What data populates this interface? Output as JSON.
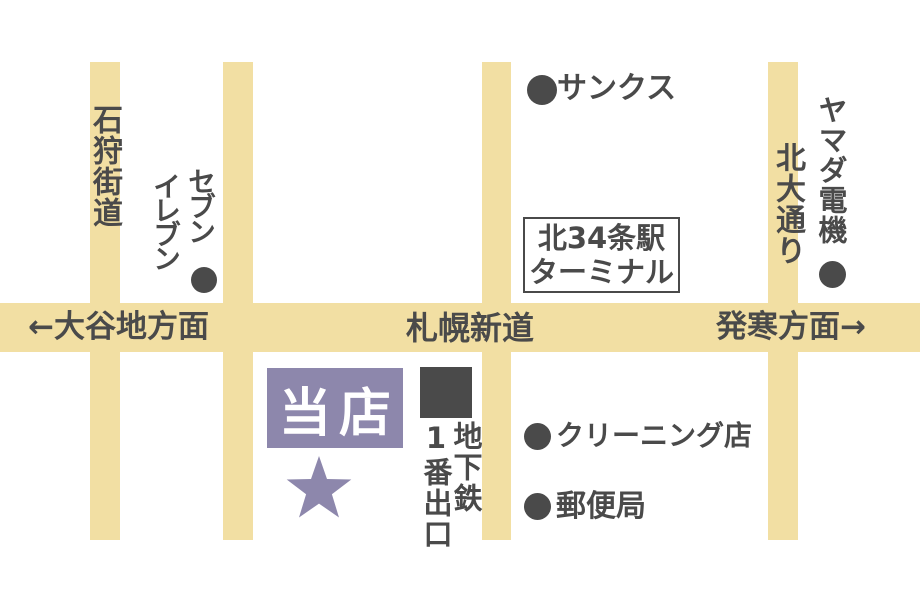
{
  "colors": {
    "background": "#ffffff",
    "road": "#f2dfa3",
    "ink": "#4a4a4a",
    "accent": "#8d87ac",
    "store_text": "#ffffff"
  },
  "roads": {
    "left_vertical_name": "石狩街道",
    "right_vertical_name": "北大通り",
    "horizontal_name": "札幌新道",
    "west_direction": "←大谷地方面",
    "east_direction": "発寒方面→"
  },
  "landmarks": {
    "seven_eleven": {
      "column_right": "セブン",
      "column_left": "イレブン"
    },
    "sunkus": "サンクス",
    "station_terminal": {
      "line1": "北34条駅",
      "line2": "ターミナル"
    },
    "yamada_denki": "ヤマダ電機",
    "cleaning_shop": "クリーニング店",
    "post_office": "郵便局",
    "subway_exit": {
      "column_right": "地下鉄",
      "column_left": "1番出口"
    },
    "store": "当店"
  }
}
